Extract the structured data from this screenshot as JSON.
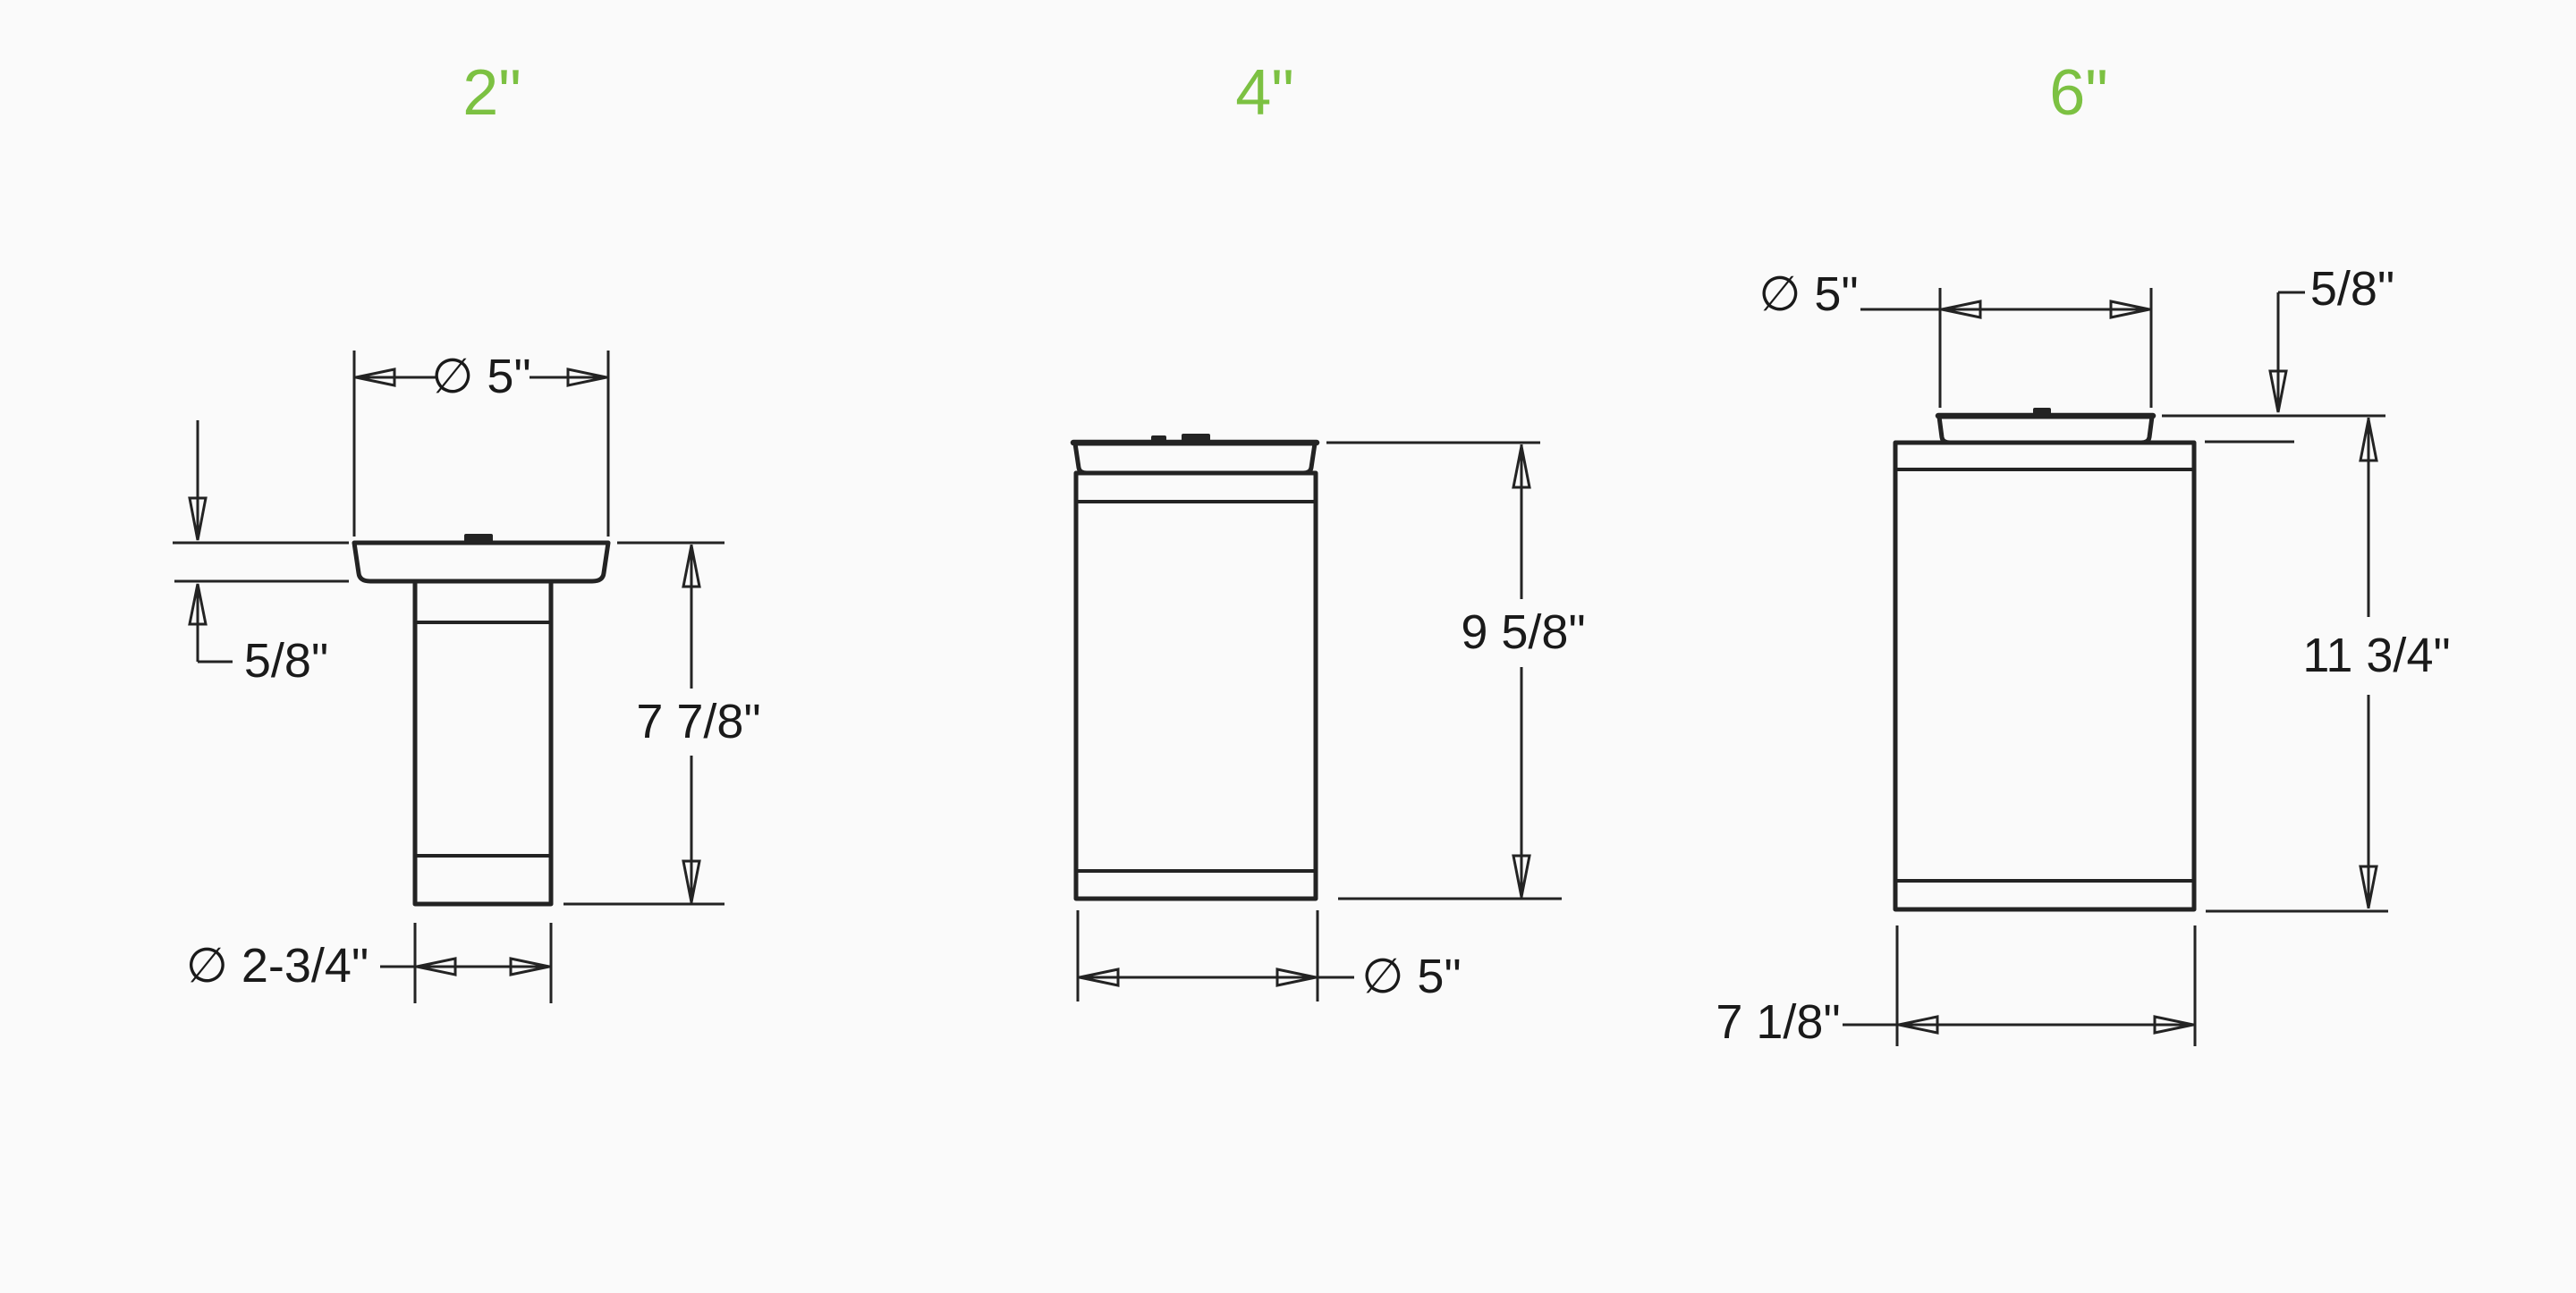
{
  "canvas": {
    "background": "#fafafa",
    "line_color": "#232323",
    "text_color": "#1a1a1a",
    "accent_green": "#7cc142"
  },
  "drawings": [
    {
      "id": "2-inch",
      "title": "2\"",
      "dims": {
        "diameter_top": "∅ 5\"",
        "canopy_thickness": "5/8\"",
        "height": "7 7/8\"",
        "diameter_bottom": "∅ 2-3/4\""
      }
    },
    {
      "id": "4-inch",
      "title": "4\"",
      "dims": {
        "height": "9 5/8\"",
        "diameter_bottom": "∅ 5\""
      }
    },
    {
      "id": "6-inch",
      "title": "6\"",
      "dims": {
        "diameter_top": "∅ 5\"",
        "canopy_offset": "5/8\"",
        "height": "11 3/4\"",
        "width_bottom": "7 1/8\""
      }
    }
  ]
}
